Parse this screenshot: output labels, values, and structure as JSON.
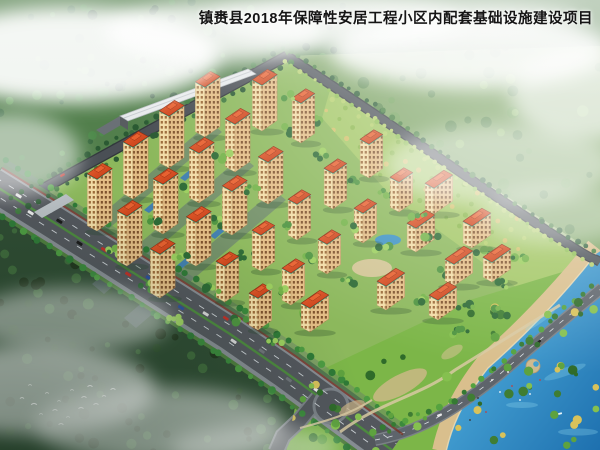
{
  "title": "镇赉县2018年保障性安居工程小区内配套基础设施建设项目",
  "scene_type": "aerial-architectural-rendering-of-residential-district",
  "palette": {
    "bg_top": "#b7cb9a",
    "bg_bottom": "#8fae76",
    "roof": "#c23b16",
    "roof_light": "#e8602f",
    "facade": "#f2dca6",
    "facade_shade": "#e3bd85",
    "window": "#9c6b3a",
    "window_shade": "#7e522c",
    "trim_teal": "#2fae92",
    "asphalt": "#53575d",
    "sidewalk": "#878d93",
    "verge": "#4f7e3e",
    "wall_red": "#7a2e1e",
    "slate_paving": "#5d6b77",
    "water_deep": "#1d6fae",
    "water_light": "#5ec0ea",
    "beach_sand": "#d9bf8d",
    "pond_blue": "#3e93c4",
    "park_green": "#7cb648",
    "estate_lawn": "#8cb85c",
    "orchard_green": "#a3c765",
    "forest_dark": "#2f4c33",
    "forest_mid": "#527f4c",
    "forest_haze": "#7da465",
    "strip_roof": "#e7eaec",
    "mist_white": "#ffffff"
  },
  "buildings": {
    "tower_count": 32,
    "towers": [
      [
        97,
        231,
        52,
        "t"
      ],
      [
        133,
        199,
        52,
        "t"
      ],
      [
        169,
        168,
        52,
        "t"
      ],
      [
        205,
        137,
        50,
        "t"
      ],
      [
        127,
        266,
        50,
        "t"
      ],
      [
        163,
        234,
        50,
        "t"
      ],
      [
        199,
        203,
        50,
        "t"
      ],
      [
        235,
        172,
        48,
        "t"
      ],
      [
        160,
        298,
        44,
        "t"
      ],
      [
        196,
        266,
        44,
        "t"
      ],
      [
        232,
        235,
        44,
        "t"
      ],
      [
        268,
        204,
        42,
        "t"
      ],
      [
        262,
        131,
        46,
        "t"
      ],
      [
        301,
        143,
        40,
        "m"
      ],
      [
        225,
        302,
        36,
        "m"
      ],
      [
        261,
        271,
        36,
        "m"
      ],
      [
        297,
        240,
        36,
        "m"
      ],
      [
        333,
        209,
        36,
        "m"
      ],
      [
        369,
        178,
        34,
        "m"
      ],
      [
        258,
        330,
        32,
        "m"
      ],
      [
        291,
        305,
        32,
        "m"
      ],
      [
        327,
        274,
        30,
        "m"
      ],
      [
        363,
        243,
        30,
        "m"
      ],
      [
        399,
        212,
        30,
        "m"
      ],
      [
        310,
        332,
        24,
        "s"
      ],
      [
        386,
        310,
        24,
        "s"
      ],
      [
        434,
        214,
        26,
        "s"
      ],
      [
        416,
        252,
        24,
        "s"
      ],
      [
        472,
        248,
        22,
        "s"
      ],
      [
        454,
        286,
        22,
        "s"
      ],
      [
        492,
        282,
        20,
        "s"
      ],
      [
        438,
        320,
        20,
        "s"
      ]
    ],
    "strip_building": {
      "label": "white-roof-commercial-strip"
    }
  },
  "clouds": [
    [
      70,
      55,
      150,
      48,
      0.92
    ],
    [
      215,
      32,
      110,
      30,
      0.8
    ],
    [
      335,
      22,
      125,
      26,
      0.7
    ],
    [
      470,
      50,
      140,
      38,
      0.85
    ],
    [
      585,
      95,
      75,
      45,
      0.6
    ],
    [
      420,
      18,
      160,
      22,
      0.5
    ],
    [
      500,
      165,
      115,
      40,
      0.45
    ],
    [
      555,
      215,
      75,
      30,
      0.35
    ],
    [
      10,
      155,
      70,
      42,
      0.55
    ],
    [
      70,
      320,
      100,
      32,
      0.5
    ],
    [
      35,
      390,
      120,
      45,
      0.65
    ],
    [
      160,
      425,
      125,
      38,
      0.55
    ],
    [
      255,
      448,
      85,
      22,
      0.4
    ]
  ],
  "birds": [
    [
      22,
      398
    ],
    [
      34,
      404
    ],
    [
      47,
      393
    ],
    [
      59,
      401
    ],
    [
      72,
      390
    ],
    [
      84,
      397
    ],
    [
      96,
      404
    ],
    [
      41,
      414
    ],
    [
      55,
      410
    ],
    [
      68,
      417
    ],
    [
      81,
      408
    ],
    [
      30,
      385
    ],
    [
      104,
      396
    ],
    [
      90,
      386
    ],
    [
      61,
      424
    ],
    [
      113,
      389
    ]
  ],
  "cars": {
    "colors": [
      "#e8e8e8",
      "#1a1a1a",
      "#c03028",
      "#2a4f9e",
      "#d8d8d8",
      "#6f747a",
      "#e8e8e8",
      "#232323",
      "#b8b8b8",
      "#c03028",
      "#e8e8e8",
      "#34383d",
      "#d04838"
    ]
  }
}
